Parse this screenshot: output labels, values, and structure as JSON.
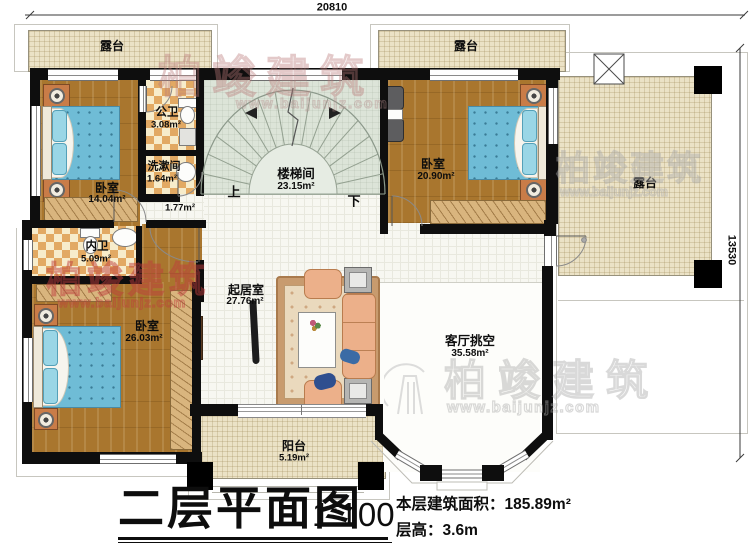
{
  "dimensions": {
    "top": "20810",
    "right": "13530"
  },
  "rooms": {
    "terrace_top_left": {
      "name": "露台"
    },
    "terrace_top_right": {
      "name": "露台"
    },
    "terrace_right": {
      "name": "露台"
    },
    "bedroom_top_left": {
      "name": "卧室",
      "area": "14.04m²"
    },
    "public_bath": {
      "name": "公卫",
      "area": "3.08m²"
    },
    "washroom": {
      "name": "洗漱间",
      "area": "1.64m²"
    },
    "stairwell": {
      "name": "楼梯间",
      "area": "23.15m²"
    },
    "corridor": {
      "area": "1.77m²"
    },
    "bedroom_top_right": {
      "name": "卧室",
      "area": "20.90m²"
    },
    "ensuite_bath": {
      "name": "内卫",
      "area": "5.09m²"
    },
    "bedroom_bottom_left": {
      "name": "卧室",
      "area": "26.03m²"
    },
    "living_room": {
      "name": "起居室",
      "area": "27.76m²"
    },
    "living_void": {
      "name": "客厅挑空",
      "area": "35.58m²"
    },
    "balcony": {
      "name": "阳台",
      "area": "5.19m²"
    }
  },
  "stairs": {
    "up": "上",
    "down": "下"
  },
  "title": {
    "main": "二层平面图",
    "scale": "1:100",
    "area_label": "本层建筑面积：",
    "area_value": "185.89m²",
    "height_label": "层高：",
    "height_value": "3.6m"
  },
  "watermark": {
    "brand": "柏竣建筑",
    "url": "www.baijunjz.com"
  },
  "colors": {
    "wall": "#0e0e0e",
    "terrace": "#ebe2c6",
    "wood": "#a9762e",
    "stair": "#dce4d8",
    "bed": "#6fbcd6"
  }
}
